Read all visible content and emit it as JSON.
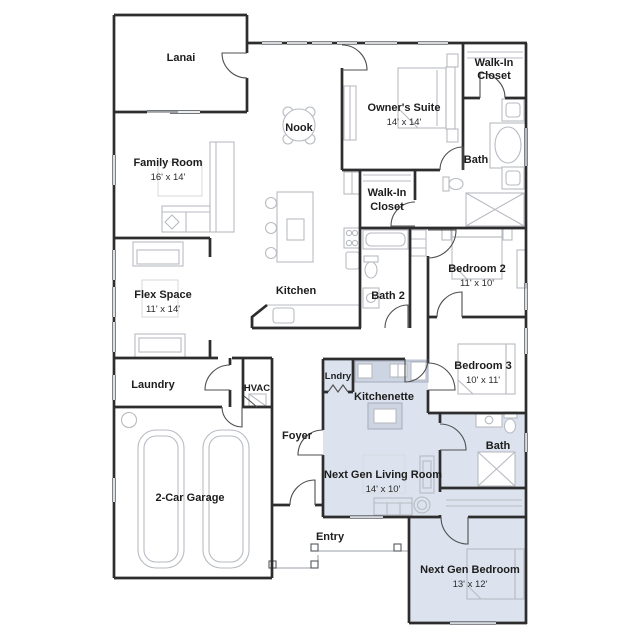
{
  "title": "Floor Plan",
  "colors": {
    "background": "#ffffff",
    "wall": "#2d2d2d",
    "furniture_line": "#b7bbc2",
    "next_gen_fill": "#dce3ee",
    "counter_fill": "#cdd5e3",
    "label_text": "#1d1d1d"
  },
  "rooms": {
    "lanai": {
      "label": "Lanai"
    },
    "family_room": {
      "label": "Family Room",
      "dims": "16' x 14'"
    },
    "nook": {
      "label": "Nook"
    },
    "owners_suite": {
      "label": "Owner's Suite",
      "dims": "14' x 14'"
    },
    "walk_in_closet_owner": {
      "line1": "Walk-In",
      "line2": "Closet"
    },
    "owners_bath": {
      "label": "Bath"
    },
    "walk_in_closet_hall": {
      "line1": "Walk-In",
      "line2": "Closet"
    },
    "bedroom_2": {
      "label": "Bedroom 2",
      "dims": "11' x 10'"
    },
    "flex_space": {
      "label": "Flex Space",
      "dims": "11' x 14'"
    },
    "kitchen": {
      "label": "Kitchen"
    },
    "bath_2": {
      "label": "Bath 2"
    },
    "bedroom_3": {
      "label": "Bedroom 3",
      "dims": "10' x 11'"
    },
    "laundry": {
      "label": "Laundry"
    },
    "hvac": {
      "label": "HVAC"
    },
    "lndry": {
      "label": "Lndry"
    },
    "kitchenette": {
      "label": "Kitchenette"
    },
    "foyer": {
      "label": "Foyer"
    },
    "next_gen_living_room": {
      "label": "Next Gen Living Room",
      "dims": "14' x 10'"
    },
    "garage": {
      "label": "2-Car Garage"
    },
    "entry": {
      "label": "Entry"
    },
    "next_gen_bath": {
      "label": "Bath"
    },
    "next_gen_bedroom": {
      "label": "Next Gen Bedroom",
      "dims": "13' x 12'"
    }
  }
}
